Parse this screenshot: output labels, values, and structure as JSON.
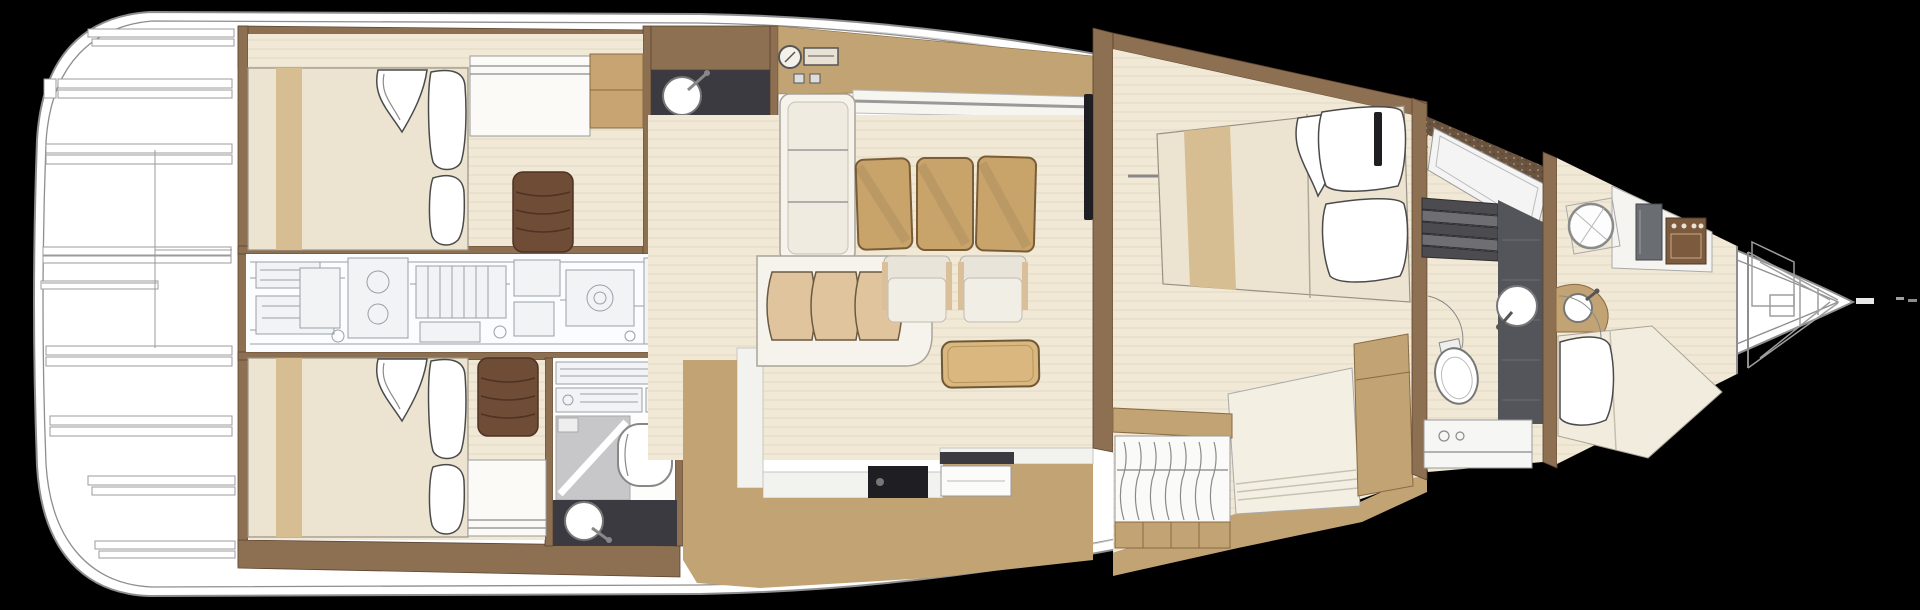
{
  "title": "Sailing yacht interior layout — deck plan (top view)",
  "canvas": {
    "width": 1920,
    "height": 610
  },
  "palette": {
    "background": "#000000",
    "hull": "#ffffff",
    "hull_line": "#8e8e8e",
    "wall": "#8d7052",
    "wall_dark": "#5f4430",
    "floor_tan": "#c2a374",
    "wood": "#f1e9d6",
    "wood_grain": "#d8cbae",
    "mattress": "#ece4d0",
    "runner": "#d6bd92",
    "ottoman": "#6f4c36",
    "ottoman_line": "#4e3223",
    "chair_tan": "#c8a46b",
    "chair_stroke": "#7a5c36",
    "cushion": "#e0c49e",
    "sofa_white": "#f6f3ec",
    "table": "#d9b77f",
    "counter_dark": "#3a3a40",
    "shower_gray": "#c7c7c9",
    "shower_dark": "#54555a",
    "machinery": "#98a0a8",
    "steps_dark": "#4c4c50",
    "speckle_brown": "#6a543f",
    "tv_black": "#1f1f23"
  },
  "regions": {
    "stern_deck": {
      "items": [
        "transom",
        "deck-slats",
        "deck-seams"
      ]
    },
    "aft_cabin_port": {
      "items": [
        "double-bed",
        "bed-runner",
        "pillows",
        "folded-sheet",
        "dresser",
        "cabinet",
        "ottoman"
      ]
    },
    "aft_cabin_starboard": {
      "items": [
        "double-bed",
        "bed-runner",
        "pillows",
        "folded-sheet",
        "dresser",
        "ottoman"
      ]
    },
    "engine_room": {
      "items": [
        "engine-block",
        "machinery-drawing",
        "piping"
      ]
    },
    "bathroom_port": {
      "items": [
        "vanity-counter",
        "washbasin",
        "shower",
        "toilet",
        "washer-units"
      ]
    },
    "bathroom_starboard": {
      "items": [
        "vanity-counter",
        "washbasin",
        "shower",
        "toilet",
        "washer-units"
      ]
    },
    "galley": {
      "items": [
        "sink-dial",
        "cooktop",
        "switch-panels",
        "counter"
      ]
    },
    "salon": {
      "items": [
        "l-sofa",
        "sideboard",
        "curved-settee",
        "settee-cushions",
        "dining-chairs",
        "armchairs",
        "coffee-table",
        "tv-sideboard",
        "side-table",
        "floor-steps"
      ]
    },
    "owners_cabin": {
      "items": [
        "island-bed",
        "bed-runner",
        "pillows",
        "folded-sheet",
        "tv-panels",
        "handrail",
        "chaise-sofa",
        "cabinet",
        "open-wardrobe-with-hangers"
      ]
    },
    "forward_head": {
      "items": [
        "deck-hatch",
        "companionway-steps",
        "shower-strip",
        "washbasin",
        "toilet",
        "vanity",
        "door-arc"
      ]
    },
    "bow_cabin": {
      "items": [
        "circular-shower",
        "arc-vanity",
        "washbasin",
        "berth",
        "pillow",
        "mini-galley-stove",
        "fridge",
        "door-arc"
      ]
    },
    "forepeak": {
      "items": [
        "watertight-bulkhead",
        "sail-locker",
        "bow-point",
        "bow-fitting"
      ]
    }
  }
}
